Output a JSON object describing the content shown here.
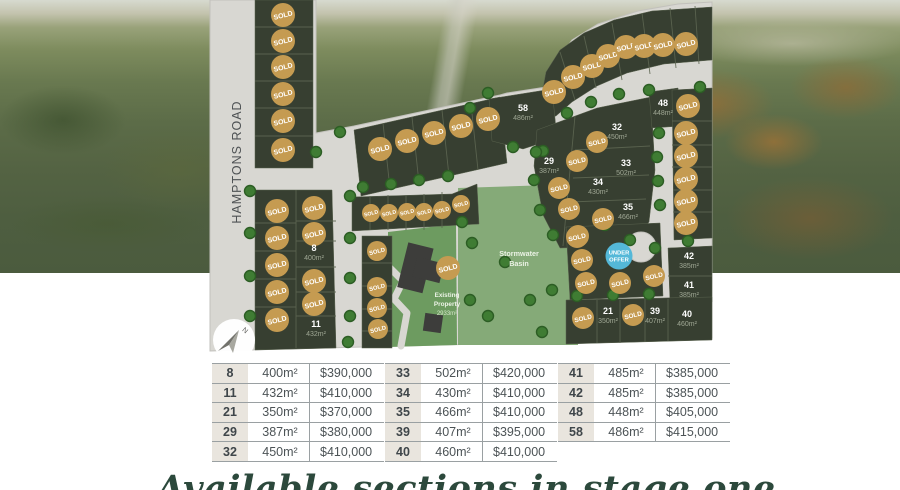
{
  "plan": {
    "road_label": "HAMPTONS ROAD",
    "sold_label": "SOLD",
    "compass_label": "N",
    "under_offer": {
      "x": 619,
      "y": 256,
      "line1": "UNDER",
      "line2": "OFFER"
    },
    "stormwater_label": {
      "line1": "Stormwater",
      "line2": "Basin"
    },
    "existing_label": {
      "line1": "Existing",
      "line2": "Property",
      "area": "2933m²"
    },
    "colors": {
      "sold": "#c59b51",
      "sold_text": "#ffffff",
      "under_offer": "#54b8d8",
      "lot": "#373f31",
      "road": "#d8d7d2",
      "basin_green": "#85aa78",
      "tree": "#3f7c33",
      "tree_edge": "#2c5d24",
      "lot_number_text": "#ffffff",
      "lot_area_text": "#9fa794"
    },
    "numbered_lots": [
      {
        "num": "8",
        "area": "400m²",
        "x": 314,
        "y": 251
      },
      {
        "num": "11",
        "area": "432m²",
        "x": 316,
        "y": 327
      },
      {
        "num": "21",
        "area": "350m²",
        "x": 608,
        "y": 314
      },
      {
        "num": "29",
        "area": "387m²",
        "x": 549,
        "y": 164
      },
      {
        "num": "32",
        "area": "450m²",
        "x": 617,
        "y": 130
      },
      {
        "num": "33",
        "area": "502m²",
        "x": 626,
        "y": 166
      },
      {
        "num": "34",
        "area": "430m²",
        "x": 598,
        "y": 185
      },
      {
        "num": "35",
        "area": "466m²",
        "x": 628,
        "y": 210
      },
      {
        "num": "39",
        "area": "407m²",
        "x": 655,
        "y": 314
      },
      {
        "num": "40",
        "area": "460m²",
        "x": 687,
        "y": 317
      },
      {
        "num": "41",
        "area": "385m²",
        "x": 689,
        "y": 288
      },
      {
        "num": "42",
        "area": "385m²",
        "x": 689,
        "y": 259
      },
      {
        "num": "48",
        "area": "448m²",
        "x": 663,
        "y": 106
      },
      {
        "num": "58",
        "area": "486m²",
        "x": 523,
        "y": 111
      }
    ],
    "sold_markers": [
      [
        283,
        15,
        12
      ],
      [
        283,
        41,
        12
      ],
      [
        283,
        67,
        12
      ],
      [
        283,
        94,
        12
      ],
      [
        283,
        121,
        12
      ],
      [
        283,
        150,
        12
      ],
      [
        277,
        211,
        12
      ],
      [
        277,
        238,
        12
      ],
      [
        277,
        265,
        12
      ],
      [
        277,
        292,
        12
      ],
      [
        277,
        320,
        12
      ],
      [
        314,
        208,
        12
      ],
      [
        314,
        234,
        12
      ],
      [
        314,
        281,
        12
      ],
      [
        314,
        304,
        12
      ],
      [
        380,
        149,
        12
      ],
      [
        407,
        141,
        12
      ],
      [
        434,
        133,
        12
      ],
      [
        461,
        126,
        12
      ],
      [
        488,
        119,
        12
      ],
      [
        371,
        213,
        9
      ],
      [
        389,
        213,
        9
      ],
      [
        407,
        212,
        9
      ],
      [
        424,
        212,
        9
      ],
      [
        442,
        210,
        9
      ],
      [
        461,
        204,
        9
      ],
      [
        377,
        251,
        10
      ],
      [
        377,
        287,
        10
      ],
      [
        377,
        308,
        10
      ],
      [
        378,
        329,
        10
      ],
      [
        554,
        92,
        12
      ],
      [
        573,
        77,
        12
      ],
      [
        592,
        66,
        12
      ],
      [
        608,
        56,
        12
      ],
      [
        626,
        47,
        12
      ],
      [
        644,
        46,
        12
      ],
      [
        663,
        45,
        12
      ],
      [
        686,
        44,
        12
      ],
      [
        597,
        142,
        11
      ],
      [
        577,
        161,
        11
      ],
      [
        559,
        188,
        11
      ],
      [
        569,
        209,
        11
      ],
      [
        603,
        219,
        11
      ],
      [
        578,
        236,
        11
      ],
      [
        688,
        106,
        12
      ],
      [
        686,
        133,
        12
      ],
      [
        686,
        156,
        12
      ],
      [
        686,
        179,
        12
      ],
      [
        686,
        201,
        12
      ],
      [
        686,
        223,
        12
      ],
      [
        577,
        237,
        11
      ],
      [
        582,
        260,
        11
      ],
      [
        586,
        283,
        11
      ],
      [
        620,
        283,
        11
      ],
      [
        654,
        276,
        11
      ],
      [
        583,
        318,
        11
      ],
      [
        633,
        315,
        11
      ],
      [
        448,
        268,
        12
      ]
    ],
    "trees": [
      [
        250,
        191
      ],
      [
        250,
        233
      ],
      [
        250,
        276
      ],
      [
        250,
        316
      ],
      [
        350,
        196
      ],
      [
        350,
        238
      ],
      [
        350,
        278
      ],
      [
        350,
        316
      ],
      [
        348,
        342
      ],
      [
        363,
        187
      ],
      [
        391,
        184
      ],
      [
        419,
        180
      ],
      [
        448,
        176
      ],
      [
        340,
        132
      ],
      [
        316,
        152
      ],
      [
        470,
        108
      ],
      [
        488,
        93
      ],
      [
        513,
        147
      ],
      [
        543,
        151
      ],
      [
        567,
        113
      ],
      [
        591,
        102
      ],
      [
        619,
        94
      ],
      [
        649,
        90
      ],
      [
        700,
        87
      ],
      [
        536,
        152
      ],
      [
        534,
        180
      ],
      [
        540,
        210
      ],
      [
        553,
        235
      ],
      [
        659,
        133
      ],
      [
        657,
        157
      ],
      [
        658,
        181
      ],
      [
        660,
        205
      ],
      [
        472,
        243
      ],
      [
        505,
        262
      ],
      [
        530,
        300
      ],
      [
        488,
        316
      ],
      [
        552,
        290
      ],
      [
        542,
        332
      ],
      [
        470,
        300
      ],
      [
        462,
        222
      ],
      [
        577,
        296
      ],
      [
        613,
        295
      ],
      [
        649,
        294
      ],
      [
        688,
        241
      ],
      [
        630,
        240
      ],
      [
        655,
        248
      ],
      [
        605,
        225
      ]
    ]
  },
  "tables": [
    {
      "rows": [
        [
          "8",
          "400m²",
          "$390,000"
        ],
        [
          "11",
          "432m²",
          "$410,000"
        ],
        [
          "21",
          "350m²",
          "$370,000"
        ],
        [
          "29",
          "387m²",
          "$380,000"
        ],
        [
          "32",
          "450m²",
          "$410,000"
        ]
      ]
    },
    {
      "rows": [
        [
          "33",
          "502m²",
          "$420,000"
        ],
        [
          "34",
          "430m²",
          "$410,000"
        ],
        [
          "35",
          "466m²",
          "$410,000"
        ],
        [
          "39",
          "407m²",
          "$395,000"
        ],
        [
          "40",
          "460m²",
          "$410,000"
        ]
      ]
    },
    {
      "rows": [
        [
          "41",
          "485m²",
          "$385,000"
        ],
        [
          "42",
          "485m²",
          "$385,000"
        ],
        [
          "48",
          "448m²",
          "$405,000"
        ],
        [
          "58",
          "486m²",
          "$415,000"
        ]
      ]
    }
  ],
  "caption": "Available sections in stage one"
}
